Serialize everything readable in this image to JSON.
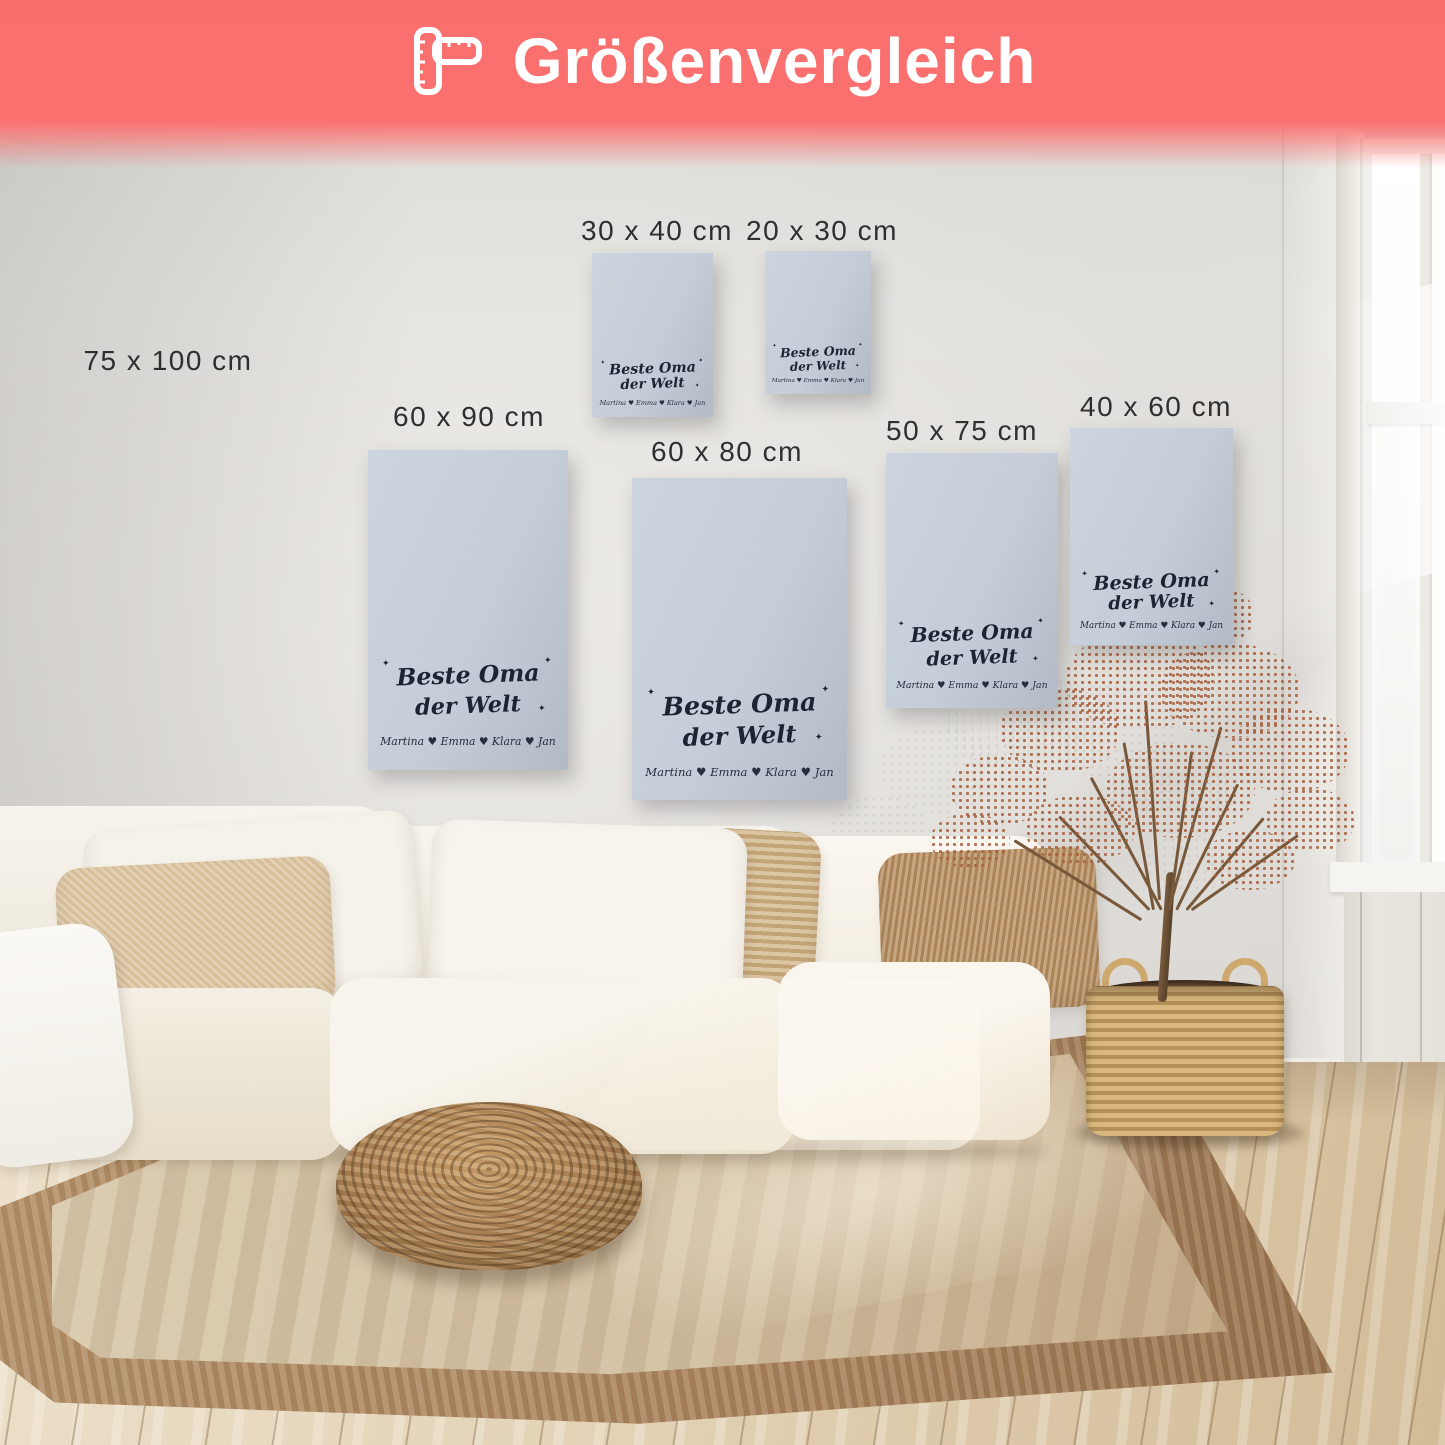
{
  "header": {
    "title": "Größenvergleich",
    "icon": "folding-ruler-icon",
    "background_color": "#FB6F6D",
    "text_color": "#FFFFFF"
  },
  "sizes": [
    {
      "id": "75x100",
      "label": "75 x 100 cm",
      "has_poster": false
    },
    {
      "id": "30x40",
      "label": "30 x 40 cm",
      "has_poster": true
    },
    {
      "id": "20x30",
      "label": "20 x 30 cm",
      "has_poster": true
    },
    {
      "id": "60x90",
      "label": "60 x 90 cm",
      "has_poster": true
    },
    {
      "id": "60x80",
      "label": "60 x 80 cm",
      "has_poster": true
    },
    {
      "id": "50x75",
      "label": "50 x 75 cm",
      "has_poster": true
    },
    {
      "id": "40x60",
      "label": "40 x 60 cm",
      "has_poster": true
    }
  ],
  "poster": {
    "title_line1": "Beste Oma",
    "title_line2": "der Welt",
    "names": "Martina ♥ Emma ♥ Klara ♥ Jan",
    "sparkle": "✦",
    "background_color": "#C7CFD9",
    "text_color": "#1C2431",
    "photos": [
      {
        "name": "photo-grandparents-picnic-grass",
        "kind": "landscape",
        "colors": [
          "#7FB23C",
          "#4E8F2F",
          "#D9E8C2"
        ]
      },
      {
        "name": "photo-family-reading-indoors",
        "kind": "landscape",
        "colors": [
          "#C9B5A2",
          "#8A7A6E",
          "#EADFD2"
        ]
      },
      {
        "name": "photo-mother-kids-window",
        "kind": "landscape",
        "colors": [
          "#9FB4C7",
          "#6B7F95",
          "#D8E2EC"
        ]
      },
      {
        "name": "photo-grandma-kids-selfie",
        "kind": "landscape",
        "colors": [
          "#E8C9C0",
          "#B68F86",
          "#F2E4DE"
        ]
      },
      {
        "name": "photo-beach-friends-arms-up",
        "kind": "beach",
        "colors": [
          "#7CC4E0",
          "#2F8FAE",
          "#EADFA8"
        ]
      },
      {
        "name": "photo-grandma-holding-child",
        "kind": "portrait",
        "colors": [
          "#2E3D2F",
          "#C8A277",
          "#E8C9A8"
        ]
      },
      {
        "name": "photo-sunset-beach-family",
        "kind": "sunset",
        "colors": [
          "#F7C948",
          "#E2671F",
          "#6E4226"
        ]
      },
      {
        "name": "photo-golden-hour-group",
        "kind": "landscape",
        "colors": [
          "#C98A4B",
          "#8A5A35",
          "#3C2B20"
        ]
      },
      {
        "name": "photo-father-child-shoulders",
        "kind": "landscape",
        "colors": [
          "#8FA96E",
          "#5D7247",
          "#CBD4C0"
        ]
      },
      {
        "name": "photo-family-baby-indoors",
        "kind": "landscape",
        "colors": [
          "#D9D9D9",
          "#A9A9AD",
          "#F0EFEF"
        ]
      },
      {
        "name": "photo-kids-flowers-garden",
        "kind": "landscape",
        "colors": [
          "#79A85B",
          "#4C7A3A",
          "#D9E6C8"
        ]
      }
    ]
  },
  "scene": {
    "wall_color": "#DCDAD6",
    "floor_color": "#E0CFAF",
    "rug_color": "#D5C3A6",
    "sofa_color": "#F5F1E8",
    "pouf_color": "#A47B4F",
    "basket_color": "#CDA96E",
    "plant_color": "#A75D3A"
  }
}
